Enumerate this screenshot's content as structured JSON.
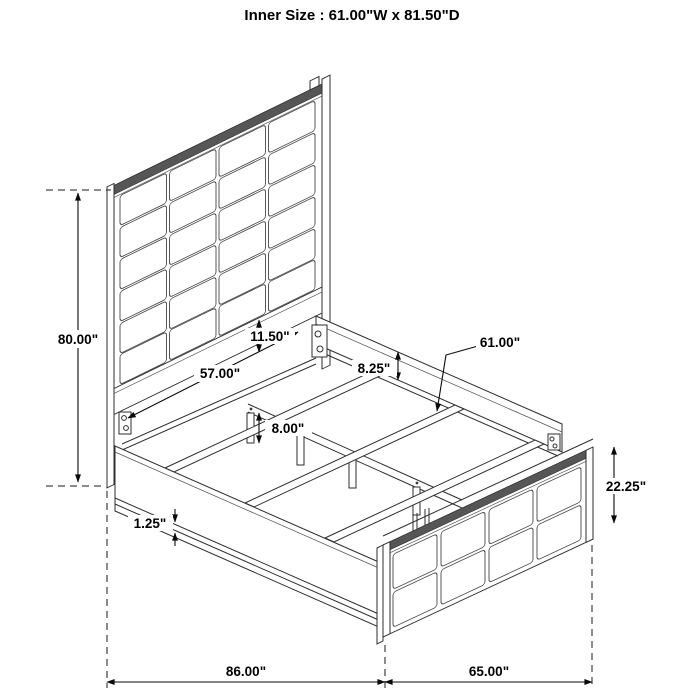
{
  "title": "Inner Size : 61.00\"W x 81.50\"D",
  "dimensions": {
    "overall_height": "80.00\"",
    "headboard_inner_width": "57.00\"",
    "headboard_bottom_gap": "11.50\"",
    "side_rail_height": "8.25\"",
    "slat_length": "61.00\"",
    "support_leg_height": "8.00\"",
    "rail_trim_height": "1.25\"",
    "footboard_height": "22.25\"",
    "overall_length": "86.00\"",
    "overall_width": "65.00\""
  }
}
